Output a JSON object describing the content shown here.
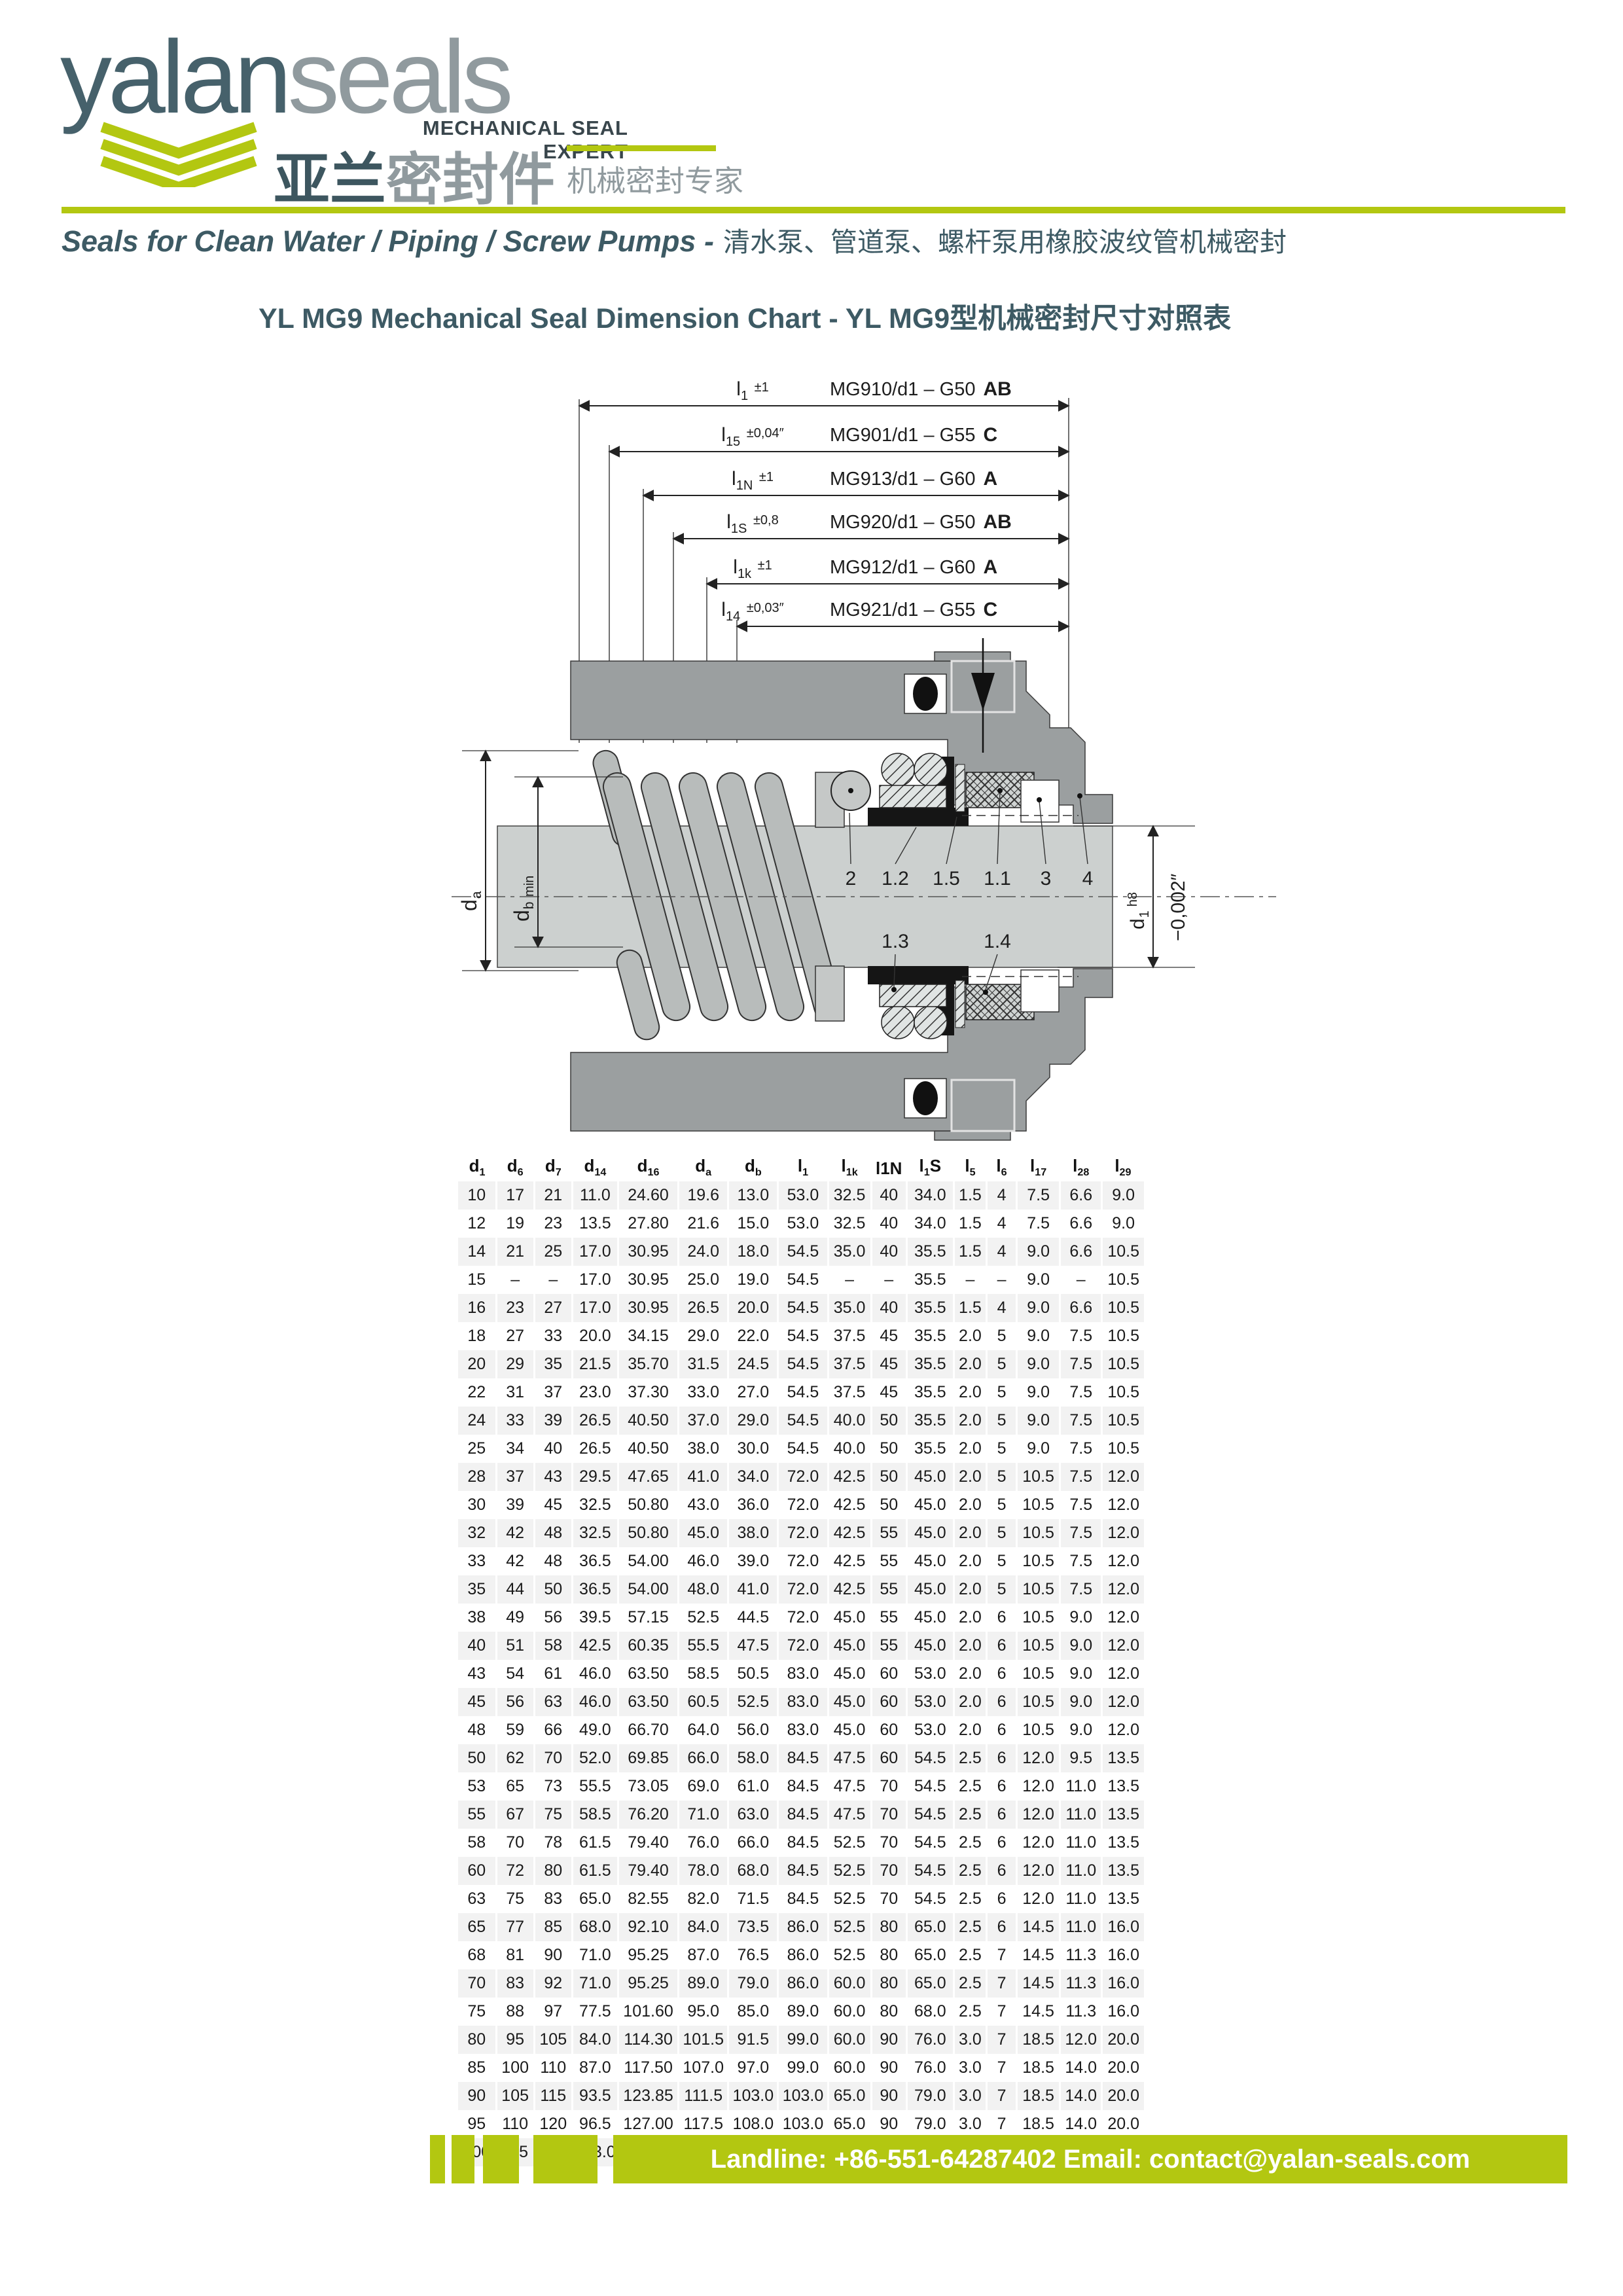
{
  "logo": {
    "brand_primary": "yalan",
    "brand_secondary": "seals",
    "tagline_en": "MECHANICAL SEAL EXPERT",
    "brand_cn_primary": "亚兰",
    "brand_cn_secondary": "密封件",
    "tagline_cn": "机械密封专家"
  },
  "header": {
    "line_en": "Seals for Clean Water / Piping / Screw Pumps -",
    "line_cn": "清水泵、管道泵、螺杆泵用橡胶波纹管机械密封"
  },
  "title": {
    "text": "YL MG9 Mechanical Seal Dimension Chart - YL MG9型机械密封尺寸对照表"
  },
  "diagram": {
    "callouts": [
      {
        "dim": "l",
        "sub": "1",
        "tol": "±1",
        "model": "MG910/d1 – G50",
        "grade": "AB"
      },
      {
        "dim": "l",
        "sub": "15",
        "tol": "±0,04″",
        "model": "MG901/d1 – G55",
        "grade": "C"
      },
      {
        "dim": "l",
        "sub": "1N",
        "tol": "±1",
        "model": "MG913/d1 – G60",
        "grade": "A"
      },
      {
        "dim": "l",
        "sub": "1S",
        "tol": "±0,8",
        "model": "MG920/d1 – G50",
        "grade": "AB"
      },
      {
        "dim": "l",
        "sub": "1k",
        "tol": "±1",
        "model": "MG912/d1 – G60",
        "grade": "A"
      },
      {
        "dim": "l",
        "sub": "14",
        "tol": "±0,03″",
        "model": "MG921/d1 – G55",
        "grade": "C"
      }
    ],
    "part_labels_top": [
      "2",
      "1.2",
      "1.5",
      "1.1",
      "3",
      "4"
    ],
    "part_labels_bottom": [
      "1.3",
      "1.4"
    ],
    "dim_left": [
      {
        "base": "d",
        "sub": "a",
        "suffix": ""
      },
      {
        "base": "d",
        "sub": "b",
        "suffix": "min"
      }
    ],
    "dim_right": {
      "base": "d",
      "sub": "1",
      "fit": "h8",
      "tol": "−0,002″"
    }
  },
  "table": {
    "headers": [
      {
        "b": "d",
        "s": "1"
      },
      {
        "b": "d",
        "s": "6"
      },
      {
        "b": "d",
        "s": "7"
      },
      {
        "b": "d",
        "s": "14"
      },
      {
        "b": "d",
        "s": "16"
      },
      {
        "b": "d",
        "s": "a"
      },
      {
        "b": "d",
        "s": "b"
      },
      {
        "b": "l",
        "s": "1"
      },
      {
        "b": "l",
        "s": "1k"
      },
      {
        "b": "l1N"
      },
      {
        "b": "l",
        "s": "1",
        "a": "S"
      },
      {
        "b": "l",
        "s": "5"
      },
      {
        "b": "l",
        "s": "6"
      },
      {
        "b": "l",
        "s": "17"
      },
      {
        "b": "l",
        "s": "28"
      },
      {
        "b": "l",
        "s": "29"
      }
    ],
    "rows": [
      [
        "10",
        "17",
        "21",
        "11.0",
        "24.60",
        "19.6",
        "13.0",
        "53.0",
        "32.5",
        "40",
        "34.0",
        "1.5",
        "4",
        "7.5",
        "6.6",
        "9.0"
      ],
      [
        "12",
        "19",
        "23",
        "13.5",
        "27.80",
        "21.6",
        "15.0",
        "53.0",
        "32.5",
        "40",
        "34.0",
        "1.5",
        "4",
        "7.5",
        "6.6",
        "9.0"
      ],
      [
        "14",
        "21",
        "25",
        "17.0",
        "30.95",
        "24.0",
        "18.0",
        "54.5",
        "35.0",
        "40",
        "35.5",
        "1.5",
        "4",
        "9.0",
        "6.6",
        "10.5"
      ],
      [
        "15",
        "–",
        "–",
        "17.0",
        "30.95",
        "25.0",
        "19.0",
        "54.5",
        "–",
        "–",
        "35.5",
        "–",
        "–",
        "9.0",
        "–",
        "10.5"
      ],
      [
        "16",
        "23",
        "27",
        "17.0",
        "30.95",
        "26.5",
        "20.0",
        "54.5",
        "35.0",
        "40",
        "35.5",
        "1.5",
        "4",
        "9.0",
        "6.6",
        "10.5"
      ],
      [
        "18",
        "27",
        "33",
        "20.0",
        "34.15",
        "29.0",
        "22.0",
        "54.5",
        "37.5",
        "45",
        "35.5",
        "2.0",
        "5",
        "9.0",
        "7.5",
        "10.5"
      ],
      [
        "20",
        "29",
        "35",
        "21.5",
        "35.70",
        "31.5",
        "24.5",
        "54.5",
        "37.5",
        "45",
        "35.5",
        "2.0",
        "5",
        "9.0",
        "7.5",
        "10.5"
      ],
      [
        "22",
        "31",
        "37",
        "23.0",
        "37.30",
        "33.0",
        "27.0",
        "54.5",
        "37.5",
        "45",
        "35.5",
        "2.0",
        "5",
        "9.0",
        "7.5",
        "10.5"
      ],
      [
        "24",
        "33",
        "39",
        "26.5",
        "40.50",
        "37.0",
        "29.0",
        "54.5",
        "40.0",
        "50",
        "35.5",
        "2.0",
        "5",
        "9.0",
        "7.5",
        "10.5"
      ],
      [
        "25",
        "34",
        "40",
        "26.5",
        "40.50",
        "38.0",
        "30.0",
        "54.5",
        "40.0",
        "50",
        "35.5",
        "2.0",
        "5",
        "9.0",
        "7.5",
        "10.5"
      ],
      [
        "28",
        "37",
        "43",
        "29.5",
        "47.65",
        "41.0",
        "34.0",
        "72.0",
        "42.5",
        "50",
        "45.0",
        "2.0",
        "5",
        "10.5",
        "7.5",
        "12.0"
      ],
      [
        "30",
        "39",
        "45",
        "32.5",
        "50.80",
        "43.0",
        "36.0",
        "72.0",
        "42.5",
        "50",
        "45.0",
        "2.0",
        "5",
        "10.5",
        "7.5",
        "12.0"
      ],
      [
        "32",
        "42",
        "48",
        "32.5",
        "50.80",
        "45.0",
        "38.0",
        "72.0",
        "42.5",
        "55",
        "45.0",
        "2.0",
        "5",
        "10.5",
        "7.5",
        "12.0"
      ],
      [
        "33",
        "42",
        "48",
        "36.5",
        "54.00",
        "46.0",
        "39.0",
        "72.0",
        "42.5",
        "55",
        "45.0",
        "2.0",
        "5",
        "10.5",
        "7.5",
        "12.0"
      ],
      [
        "35",
        "44",
        "50",
        "36.5",
        "54.00",
        "48.0",
        "41.0",
        "72.0",
        "42.5",
        "55",
        "45.0",
        "2.0",
        "5",
        "10.5",
        "7.5",
        "12.0"
      ],
      [
        "38",
        "49",
        "56",
        "39.5",
        "57.15",
        "52.5",
        "44.5",
        "72.0",
        "45.0",
        "55",
        "45.0",
        "2.0",
        "6",
        "10.5",
        "9.0",
        "12.0"
      ],
      [
        "40",
        "51",
        "58",
        "42.5",
        "60.35",
        "55.5",
        "47.5",
        "72.0",
        "45.0",
        "55",
        "45.0",
        "2.0",
        "6",
        "10.5",
        "9.0",
        "12.0"
      ],
      [
        "43",
        "54",
        "61",
        "46.0",
        "63.50",
        "58.5",
        "50.5",
        "83.0",
        "45.0",
        "60",
        "53.0",
        "2.0",
        "6",
        "10.5",
        "9.0",
        "12.0"
      ],
      [
        "45",
        "56",
        "63",
        "46.0",
        "63.50",
        "60.5",
        "52.5",
        "83.0",
        "45.0",
        "60",
        "53.0",
        "2.0",
        "6",
        "10.5",
        "9.0",
        "12.0"
      ],
      [
        "48",
        "59",
        "66",
        "49.0",
        "66.70",
        "64.0",
        "56.0",
        "83.0",
        "45.0",
        "60",
        "53.0",
        "2.0",
        "6",
        "10.5",
        "9.0",
        "12.0"
      ],
      [
        "50",
        "62",
        "70",
        "52.0",
        "69.85",
        "66.0",
        "58.0",
        "84.5",
        "47.5",
        "60",
        "54.5",
        "2.5",
        "6",
        "12.0",
        "9.5",
        "13.5"
      ],
      [
        "53",
        "65",
        "73",
        "55.5",
        "73.05",
        "69.0",
        "61.0",
        "84.5",
        "47.5",
        "70",
        "54.5",
        "2.5",
        "6",
        "12.0",
        "11.0",
        "13.5"
      ],
      [
        "55",
        "67",
        "75",
        "58.5",
        "76.20",
        "71.0",
        "63.0",
        "84.5",
        "47.5",
        "70",
        "54.5",
        "2.5",
        "6",
        "12.0",
        "11.0",
        "13.5"
      ],
      [
        "58",
        "70",
        "78",
        "61.5",
        "79.40",
        "76.0",
        "66.0",
        "84.5",
        "52.5",
        "70",
        "54.5",
        "2.5",
        "6",
        "12.0",
        "11.0",
        "13.5"
      ],
      [
        "60",
        "72",
        "80",
        "61.5",
        "79.40",
        "78.0",
        "68.0",
        "84.5",
        "52.5",
        "70",
        "54.5",
        "2.5",
        "6",
        "12.0",
        "11.0",
        "13.5"
      ],
      [
        "63",
        "75",
        "83",
        "65.0",
        "82.55",
        "82.0",
        "71.5",
        "84.5",
        "52.5",
        "70",
        "54.5",
        "2.5",
        "6",
        "12.0",
        "11.0",
        "13.5"
      ],
      [
        "65",
        "77",
        "85",
        "68.0",
        "92.10",
        "84.0",
        "73.5",
        "86.0",
        "52.5",
        "80",
        "65.0",
        "2.5",
        "6",
        "14.5",
        "11.0",
        "16.0"
      ],
      [
        "68",
        "81",
        "90",
        "71.0",
        "95.25",
        "87.0",
        "76.5",
        "86.0",
        "52.5",
        "80",
        "65.0",
        "2.5",
        "7",
        "14.5",
        "11.3",
        "16.0"
      ],
      [
        "70",
        "83",
        "92",
        "71.0",
        "95.25",
        "89.0",
        "79.0",
        "86.0",
        "60.0",
        "80",
        "65.0",
        "2.5",
        "7",
        "14.5",
        "11.3",
        "16.0"
      ],
      [
        "75",
        "88",
        "97",
        "77.5",
        "101.60",
        "95.0",
        "85.0",
        "89.0",
        "60.0",
        "80",
        "68.0",
        "2.5",
        "7",
        "14.5",
        "11.3",
        "16.0"
      ],
      [
        "80",
        "95",
        "105",
        "84.0",
        "114.30",
        "101.5",
        "91.5",
        "99.0",
        "60.0",
        "90",
        "76.0",
        "3.0",
        "7",
        "18.5",
        "12.0",
        "20.0"
      ],
      [
        "85",
        "100",
        "110",
        "87.0",
        "117.50",
        "107.0",
        "97.0",
        "99.0",
        "60.0",
        "90",
        "76.0",
        "3.0",
        "7",
        "18.5",
        "14.0",
        "20.0"
      ],
      [
        "90",
        "105",
        "115",
        "93.5",
        "123.85",
        "111.5",
        "103.0",
        "103.0",
        "65.0",
        "90",
        "79.0",
        "3.0",
        "7",
        "18.5",
        "14.0",
        "20.0"
      ],
      [
        "95",
        "110",
        "120",
        "96.5",
        "127.00",
        "117.5",
        "108.0",
        "103.0",
        "65.0",
        "90",
        "79.0",
        "3.0",
        "7",
        "18.5",
        "14.0",
        "20.0"
      ],
      [
        "100",
        "115",
        "125",
        "103.0",
        "133.35",
        "122.5",
        "114.0",
        "106.0",
        "65.0",
        "90",
        "82.0",
        "3.0",
        "7",
        "18.5",
        "14.0",
        "20.0"
      ]
    ]
  },
  "footer": {
    "contact": "Landline: +86-551-64287402 Email: contact@yalan-seals.com"
  },
  "colors": {
    "accent": "#b3c711",
    "teal": "#3d5a64",
    "brand_gray": "#909a9e"
  }
}
